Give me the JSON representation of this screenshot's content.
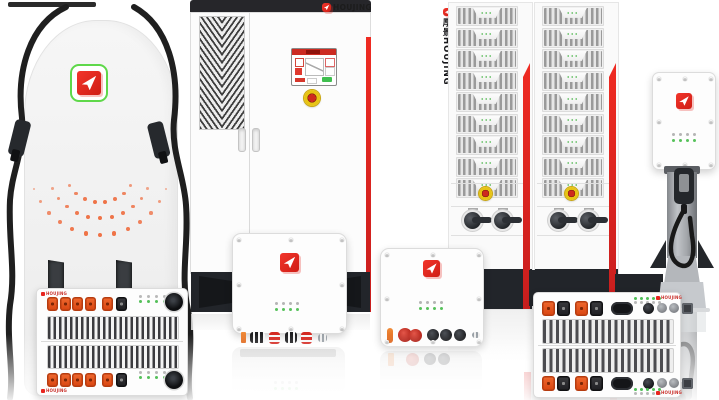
{
  "brand": {
    "name_label": "HOUJING",
    "tower_vertical_label": "厚景HOUJING"
  },
  "icons": {
    "houjing_logo": "red-square-with-white-arrow",
    "pile_logo_frame": "green-rounded-outline",
    "emergency_stop": "red-button-on-yellow-ring",
    "fan": "black-circle",
    "power_connector": "orange-square-socket",
    "signal_connector": "black-square-socket"
  },
  "colors": {
    "logo_red": "#e8251f",
    "accent_red": "#e02222",
    "connector_orange": "#e8551f",
    "led_green": "#55c05a",
    "estop_yellow": "#e8c414",
    "estop_red": "#cf2a1e",
    "dark_charcoal": "#23262b",
    "body_light": "#f2f2f2",
    "logo_frame_green": "#5fd84a"
  }
}
